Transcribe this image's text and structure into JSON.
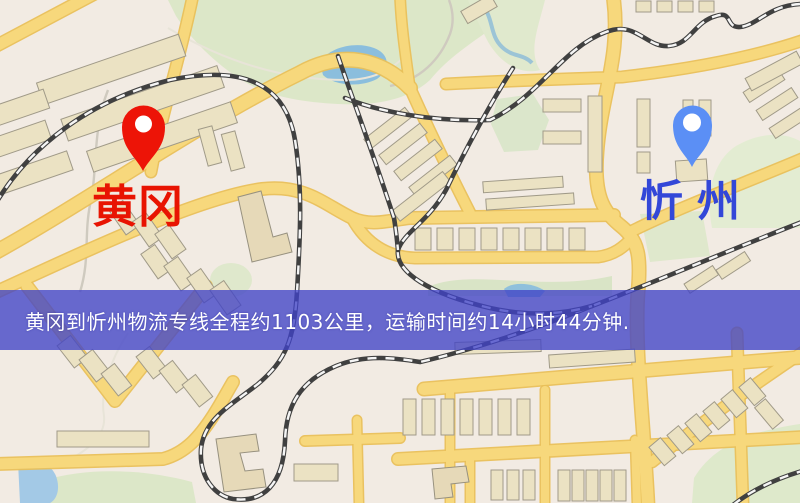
{
  "map": {
    "markers": {
      "origin": {
        "label": "黄冈",
        "pin_color": "#ed1407",
        "label_color": "#e81402"
      },
      "destination": {
        "label": "忻州",
        "pin_color": "#5b8ff5",
        "label_color": "#3347d8"
      }
    },
    "banner": {
      "text": "黄冈到忻州物流专线全程约1103公里，运输时间约14小时44分钟.",
      "background_color": "#4042c7",
      "text_color": "#ffffff"
    },
    "route": {
      "origin": "黄冈",
      "destination": "忻州",
      "distance": "约1103公里",
      "duration": "约14小时44分钟"
    },
    "palette": {
      "background": "#f2ebe3",
      "road": "#f7d87c",
      "railway": "#404040",
      "water": "#8bbedd",
      "park": "#dce7c8",
      "building": "#ebe2c3"
    }
  }
}
